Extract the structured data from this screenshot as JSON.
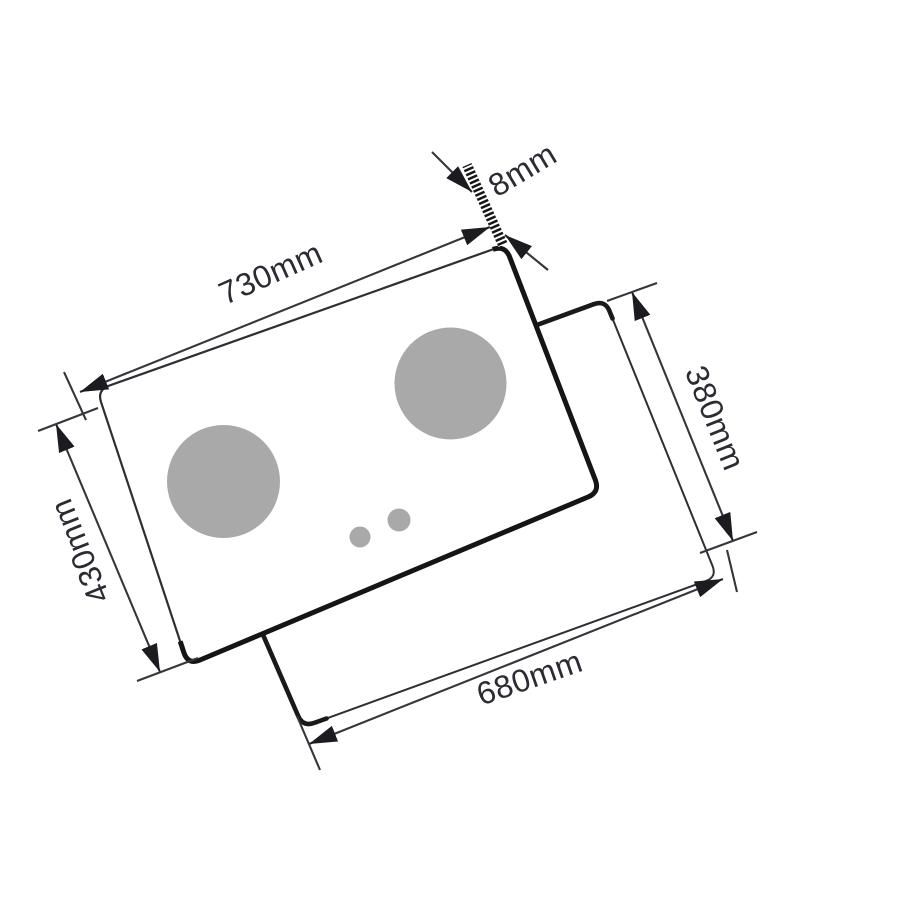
{
  "diagram": {
    "title": "Gas hob panel and cutout dimension diagram",
    "labels": {
      "panel_width": "730mm",
      "glass_thickness": "8mm",
      "cutout_height": "380mm",
      "panel_depth": "430mm",
      "cutout_width": "680mm"
    },
    "colors": {
      "background": "#ffffff",
      "outline_thick": "#1a1a1a",
      "outline_thin": "#2e2e33",
      "dim_line": "#35353b",
      "arrow_fill": "#1b1b20",
      "burner_fill": "#a9a9a9",
      "label_text": "#2b2b33"
    }
  }
}
